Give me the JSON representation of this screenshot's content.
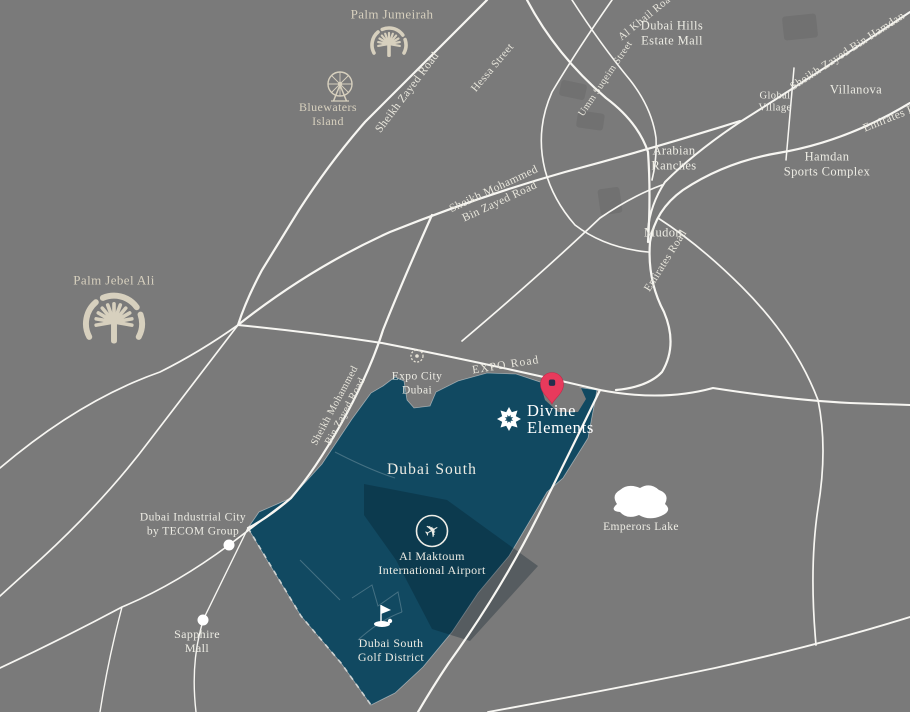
{
  "colors": {
    "background": "#7a7a7a",
    "district_fill": "#114961",
    "road": "#f7f6f2",
    "landmark_beige": "#d7d0be",
    "label_white": "#edece4",
    "pin": "#e83a5c",
    "pin_dot": "#252f4d"
  },
  "project": {
    "name_line1": "Divine",
    "name_line2": "Elements"
  },
  "district": {
    "name": "Dubai South"
  },
  "roads": {
    "sheikh_zayed": "Sheikh Zayed Road",
    "hessa": "Hessa Street",
    "al_khail": "Al Khail Road",
    "umm_suqeim": "Umm Suqeim Street",
    "szbh": "Sheikh Zayed Bin Hamdan",
    "emirates": "Emirates Road",
    "smbz_line1": "Sheikh Mohammed",
    "smbz_line2": "Bin Zayed Road",
    "expo": "EXPO Road"
  },
  "places": {
    "palm_jumeirah": "Palm Jumeirah",
    "bluewaters_line1": "Bluewaters",
    "bluewaters_line2": "Island",
    "dubai_hills_line1": "Dubai Hills",
    "dubai_hills_line2": "Estate Mall",
    "global_village_line1": "Global",
    "global_village_line2": "Village",
    "villanova": "Villanova",
    "hamdan_line1": "Hamdan",
    "hamdan_line2": "Sports Complex",
    "arabian_line1": "Arabian",
    "arabian_line2": "Ranches",
    "mudon": "Mudon",
    "palm_jebel_ali": "Palm Jebel Ali",
    "expo_city_line1": "Expo City",
    "expo_city_line2": "Dubai",
    "dic_line1": "Dubai Industrial City",
    "dic_line2": "by TECOM Group",
    "sapphire_line1": "Sapphire",
    "sapphire_line2": "Mall",
    "emperors_lake": "Emperors Lake",
    "airport_line1": "Al Maktoum",
    "airport_line2": "International Airport",
    "golf_line1": "Dubai South",
    "golf_line2": "Golf District"
  },
  "icons": {
    "airplane": "✈"
  }
}
